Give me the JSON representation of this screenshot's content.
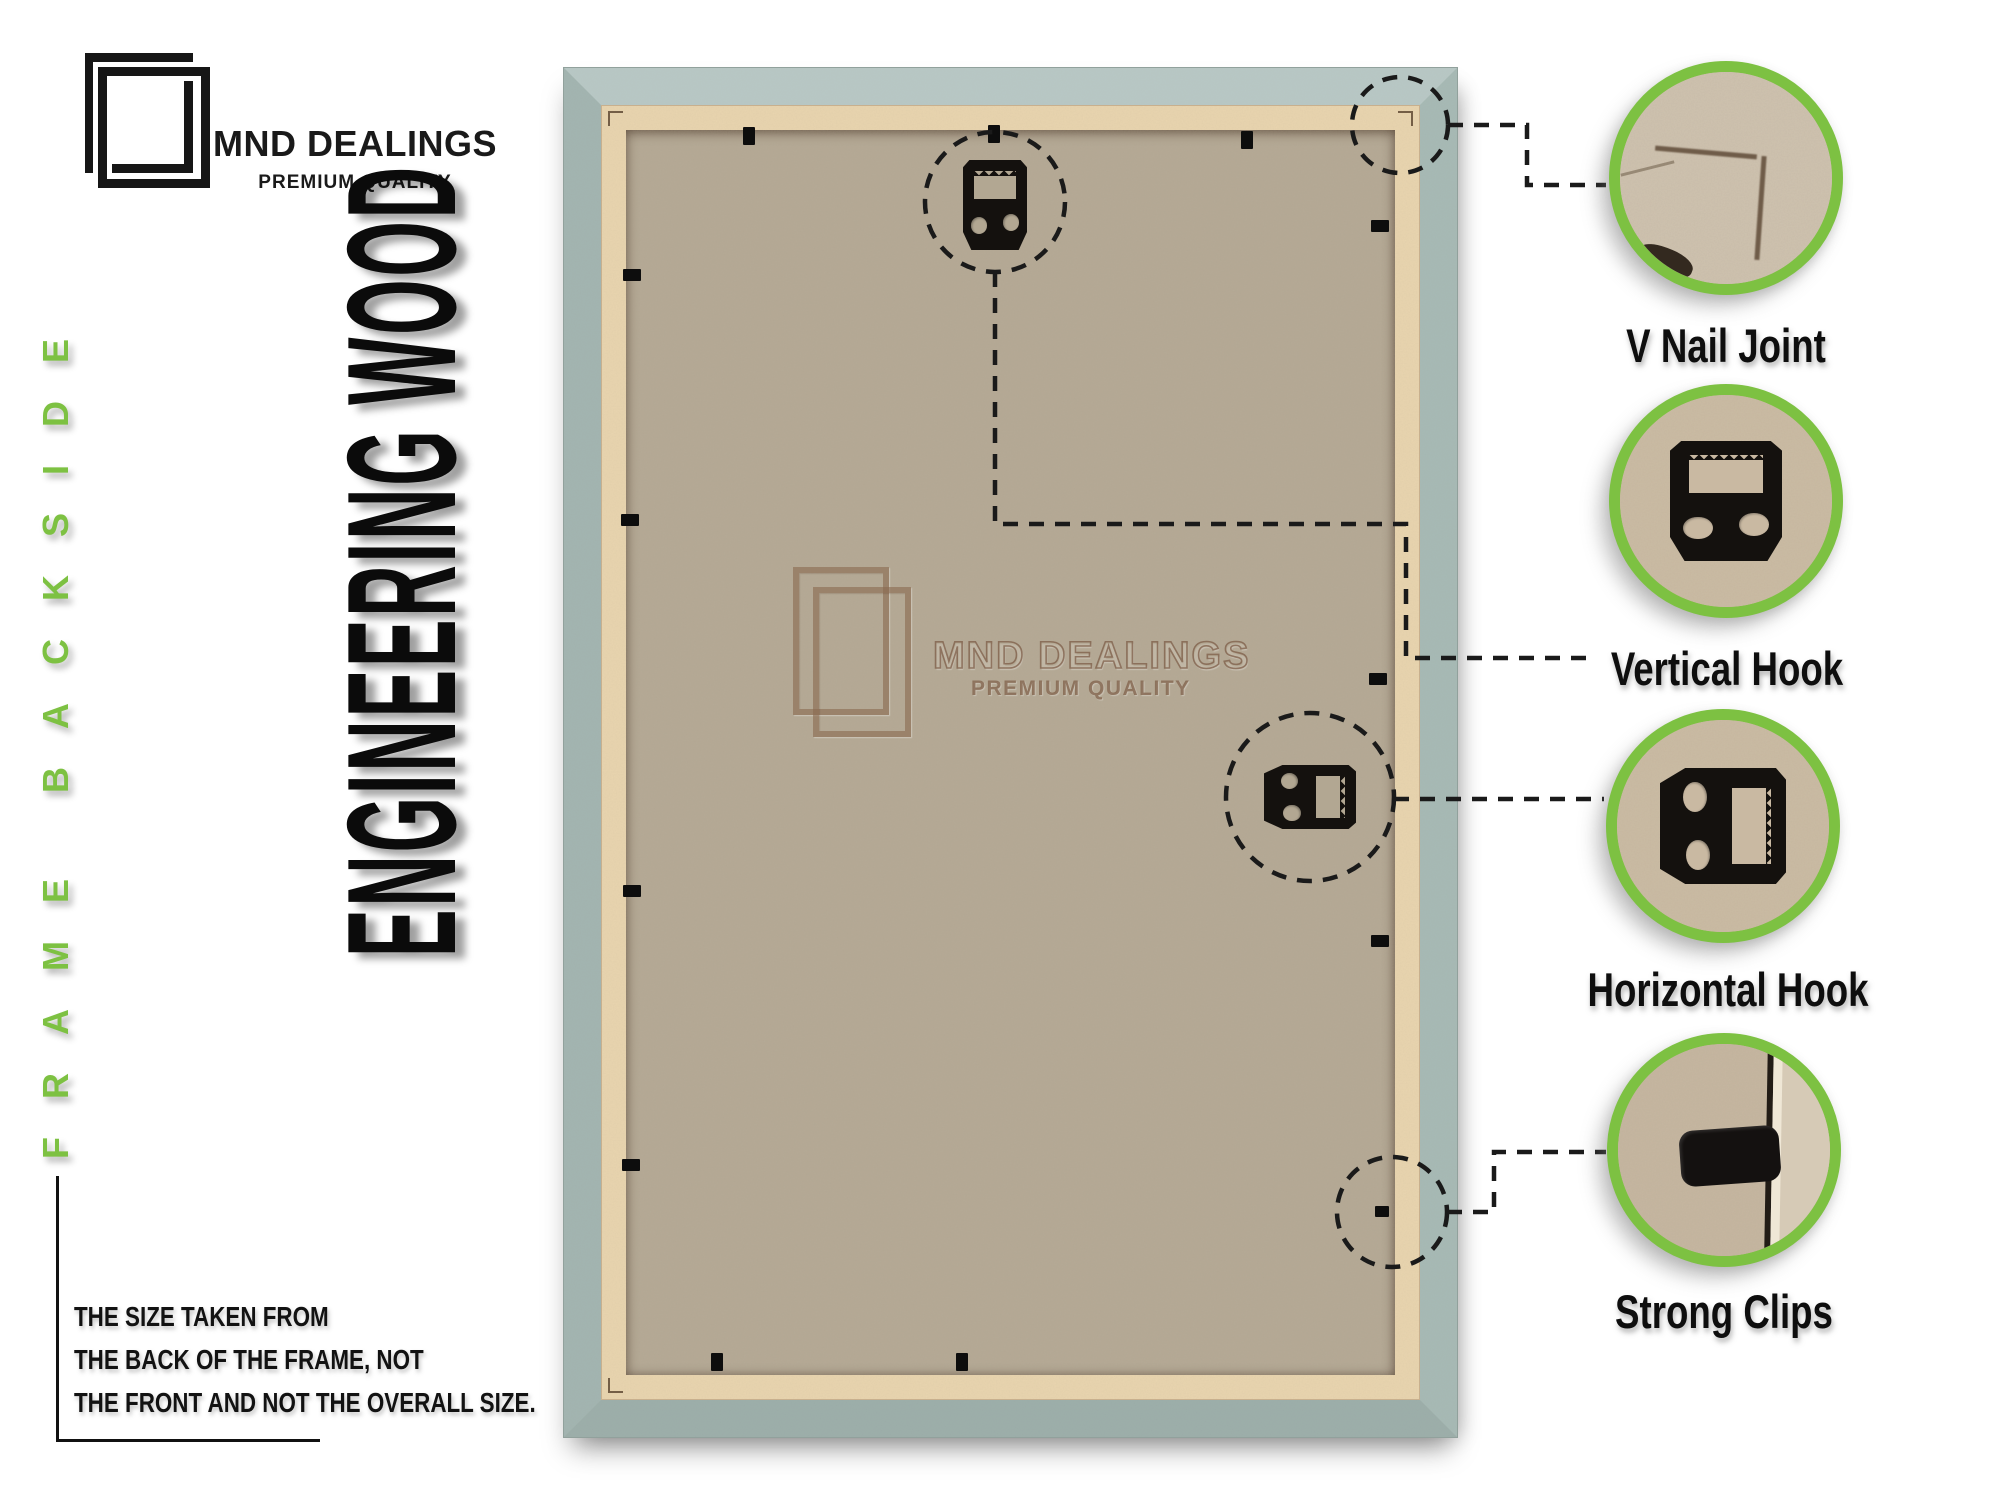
{
  "brand": {
    "name": "MND DEALINGS",
    "tagline": "PREMIUM QUALITY"
  },
  "side_label": "FRAME BACKSIDE",
  "material_label": "ENGINEERING WOOD",
  "watermark": {
    "name": "MND DEALINGS",
    "tagline": "PREMIUM QUALITY"
  },
  "callouts": [
    {
      "id": "v-nail-joint",
      "label": "V Nail Joint"
    },
    {
      "id": "vertical-hook",
      "label": "Vertical Hook"
    },
    {
      "id": "horizontal-hook",
      "label": "Horizontal Hook"
    },
    {
      "id": "strong-clips",
      "label": "Strong Clips"
    }
  ],
  "note": {
    "line1": "THE SIZE TAKEN FROM",
    "line2": "THE BACK OF THE FRAME, NOT",
    "line3": "THE FRONT AND NOT THE OVERALL SIZE."
  },
  "colors": {
    "accent_green": "#7DC142",
    "frame_sage": "#AFC1BD",
    "frame_lip": "#E9D5AF",
    "board_tan": "#B5AA96",
    "ink": "#111111"
  }
}
